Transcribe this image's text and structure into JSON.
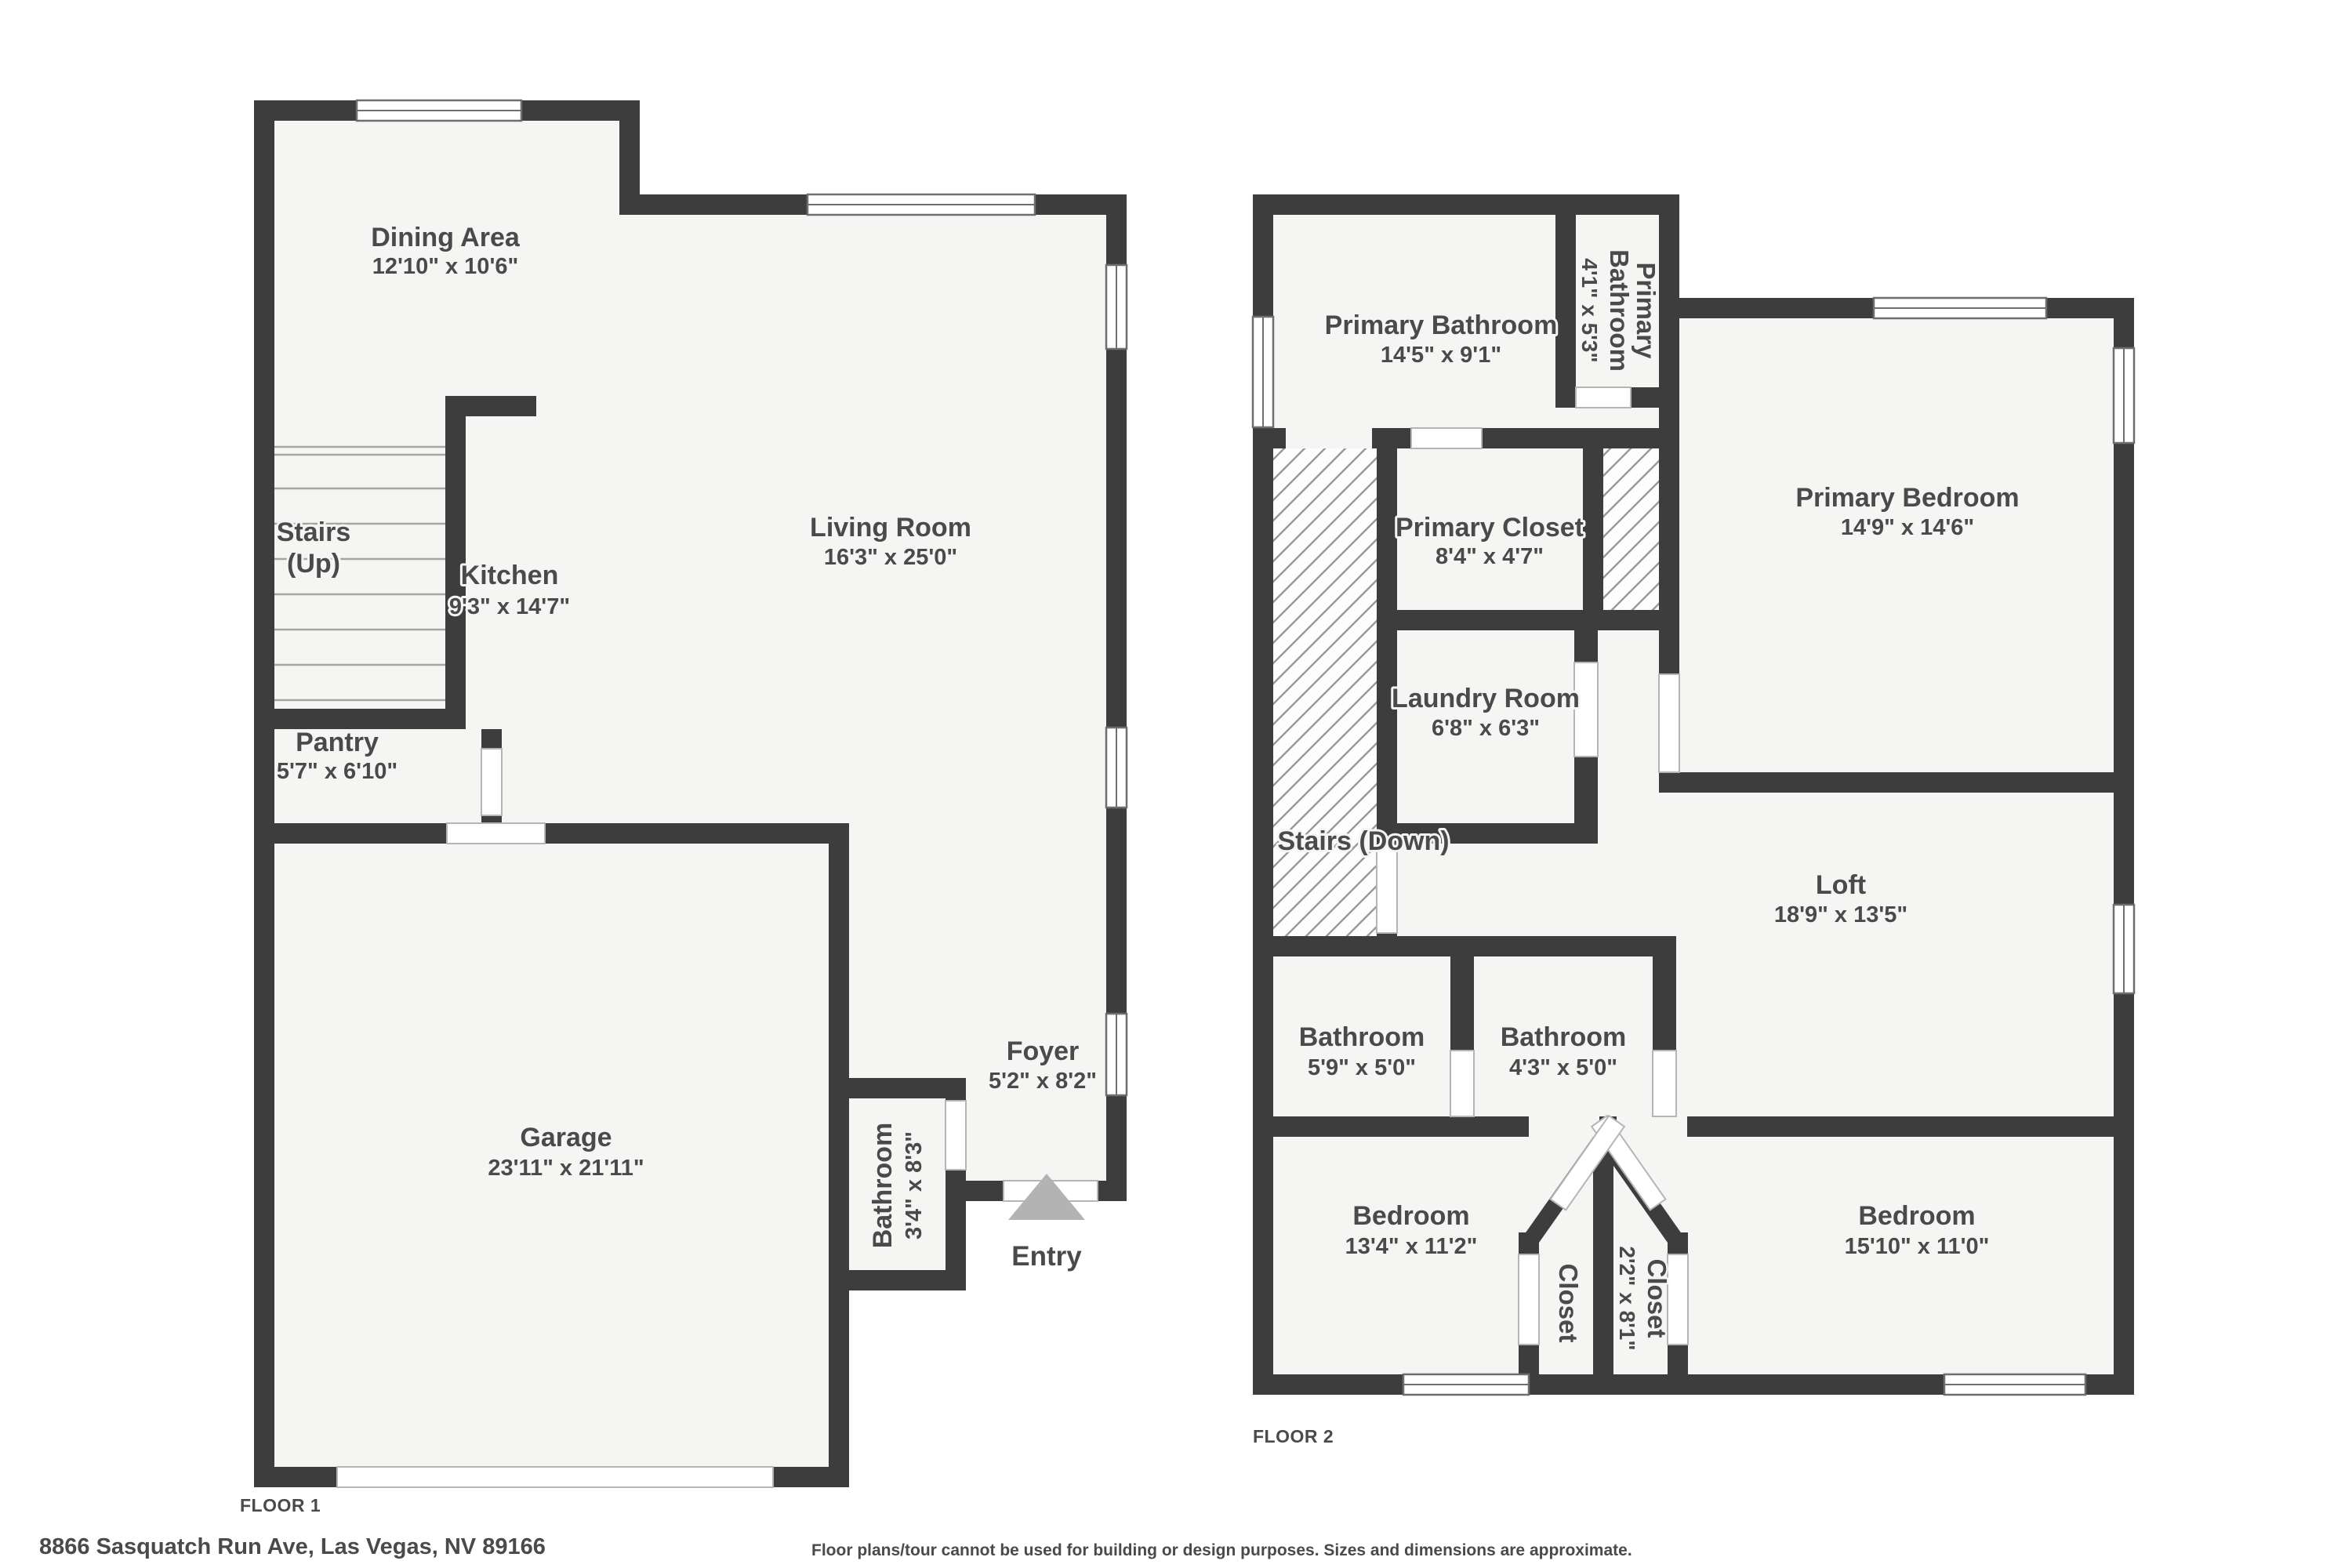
{
  "colors": {
    "wall": "#3d3d3d",
    "floor": "#f5f5f4",
    "outside": "#ffffff",
    "hatch-line": "#9a9a9a",
    "door": "#ffffff",
    "door-edge": "#b5b5b5",
    "window-frame": "#6e6e6e",
    "tread": "#a5a5a5",
    "ink": "#4a4a4a",
    "halo": "#f5f5f4",
    "entry-arrow": "#b3b3b3"
  },
  "floor1": {
    "floor_label": "FLOOR 1",
    "entry_label": "Entry",
    "rooms": {
      "dining": {
        "name": "Dining Area",
        "dims": "12'10\" x 10'6\""
      },
      "stairs": {
        "line1": "Stairs",
        "line2": "(Up)"
      },
      "kitchen": {
        "name": "Kitchen",
        "dims": "9'3\" x 14'7\""
      },
      "living": {
        "name": "Living Room",
        "dims": "16'3\" x 25'0\""
      },
      "pantry": {
        "name": "Pantry",
        "dims": "5'7\" x 6'10\""
      },
      "garage": {
        "name": "Garage",
        "dims": "23'11\" x 21'11\""
      },
      "bathroom": {
        "name": "Bathroom",
        "dims": "3'4\" x 8'3\""
      },
      "foyer": {
        "name": "Foyer",
        "dims": "5'2\" x 8'2\""
      }
    }
  },
  "floor2": {
    "floor_label": "FLOOR 2",
    "rooms": {
      "primary_bathroom": {
        "name": "Primary Bathroom",
        "dims": "14'5\" x 9'1\""
      },
      "primary_bathroom_small": {
        "line1": "Primary",
        "line2": "Bathroom",
        "dims": "4'1\" x 5'3\""
      },
      "primary_closet": {
        "name": "Primary Closet",
        "dims": "8'4\" x 4'7\""
      },
      "primary_bedroom": {
        "name": "Primary Bedroom",
        "dims": "14'9\" x 14'6\""
      },
      "laundry": {
        "name": "Laundry Room",
        "dims": "6'8\" x 6'3\""
      },
      "stairs_down": {
        "name": "Stairs (Down)"
      },
      "loft": {
        "name": "Loft",
        "dims": "18'9\" x 13'5\""
      },
      "bathroom_left": {
        "name": "Bathroom",
        "dims": "5'9\" x 5'0\""
      },
      "bathroom_right": {
        "name": "Bathroom",
        "dims": "4'3\" x 5'0\""
      },
      "bedroom_left": {
        "name": "Bedroom",
        "dims": "13'4\" x 11'2\""
      },
      "closet_left": {
        "name": "Closet"
      },
      "closet_right": {
        "name": "Closet",
        "dims": "2'2\" x 8'1\""
      },
      "bedroom_right": {
        "name": "Bedroom",
        "dims": "15'10\" x 11'0\""
      }
    }
  },
  "footer": {
    "address": "8866 Sasquatch Run Ave, Las Vegas, NV 89166",
    "disclaimer": "Floor plans/tour cannot be used for building or design purposes. Sizes and dimensions are approximate."
  }
}
